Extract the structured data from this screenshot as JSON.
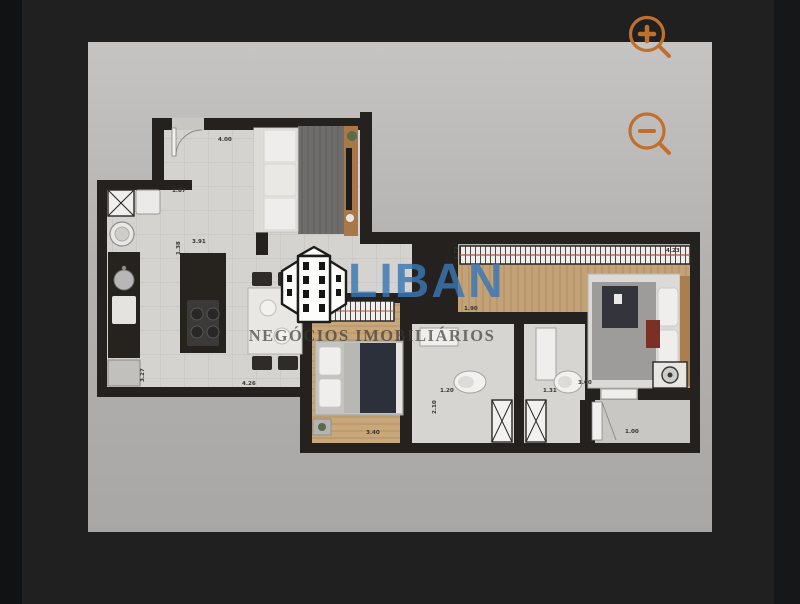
{
  "theme": {
    "accent": "#c06f2c",
    "brand-blue": "#3a77b5",
    "page-bg": "#202020"
  },
  "viewer": {
    "controls": [
      {
        "name": "zoom-in",
        "label": "Zoom in"
      },
      {
        "name": "zoom-out",
        "label": "Zoom out"
      }
    ]
  },
  "watermark": {
    "brand": "LIBAN",
    "tagline": "NEGÓCIOS IMOBILIÁRIOS"
  },
  "floorplan": {
    "dimension_labels": [
      {
        "text": "4.00",
        "x": 130,
        "y": 99
      },
      {
        "text": "1.87",
        "x": 84,
        "y": 150
      },
      {
        "text": "3.91",
        "x": 104,
        "y": 201
      },
      {
        "text": "1.38",
        "x": 92,
        "y": 213,
        "rotate": -90
      },
      {
        "text": "4.26",
        "x": 154,
        "y": 343
      },
      {
        "text": "3.27",
        "x": 56,
        "y": 340,
        "rotate": -90
      },
      {
        "text": "4.23",
        "x": 578,
        "y": 210
      },
      {
        "text": "1.72",
        "x": 370,
        "y": 218,
        "rotate": -90
      },
      {
        "text": "1.90",
        "x": 376,
        "y": 268
      },
      {
        "text": "1.20",
        "x": 352,
        "y": 350
      },
      {
        "text": "2.10",
        "x": 348,
        "y": 372,
        "rotate": -90
      },
      {
        "text": "1.31",
        "x": 455,
        "y": 350
      },
      {
        "text": "3.40",
        "x": 278,
        "y": 392
      },
      {
        "text": "3.00",
        "x": 490,
        "y": 342
      },
      {
        "text": "1.00",
        "x": 537,
        "y": 391
      }
    ]
  }
}
